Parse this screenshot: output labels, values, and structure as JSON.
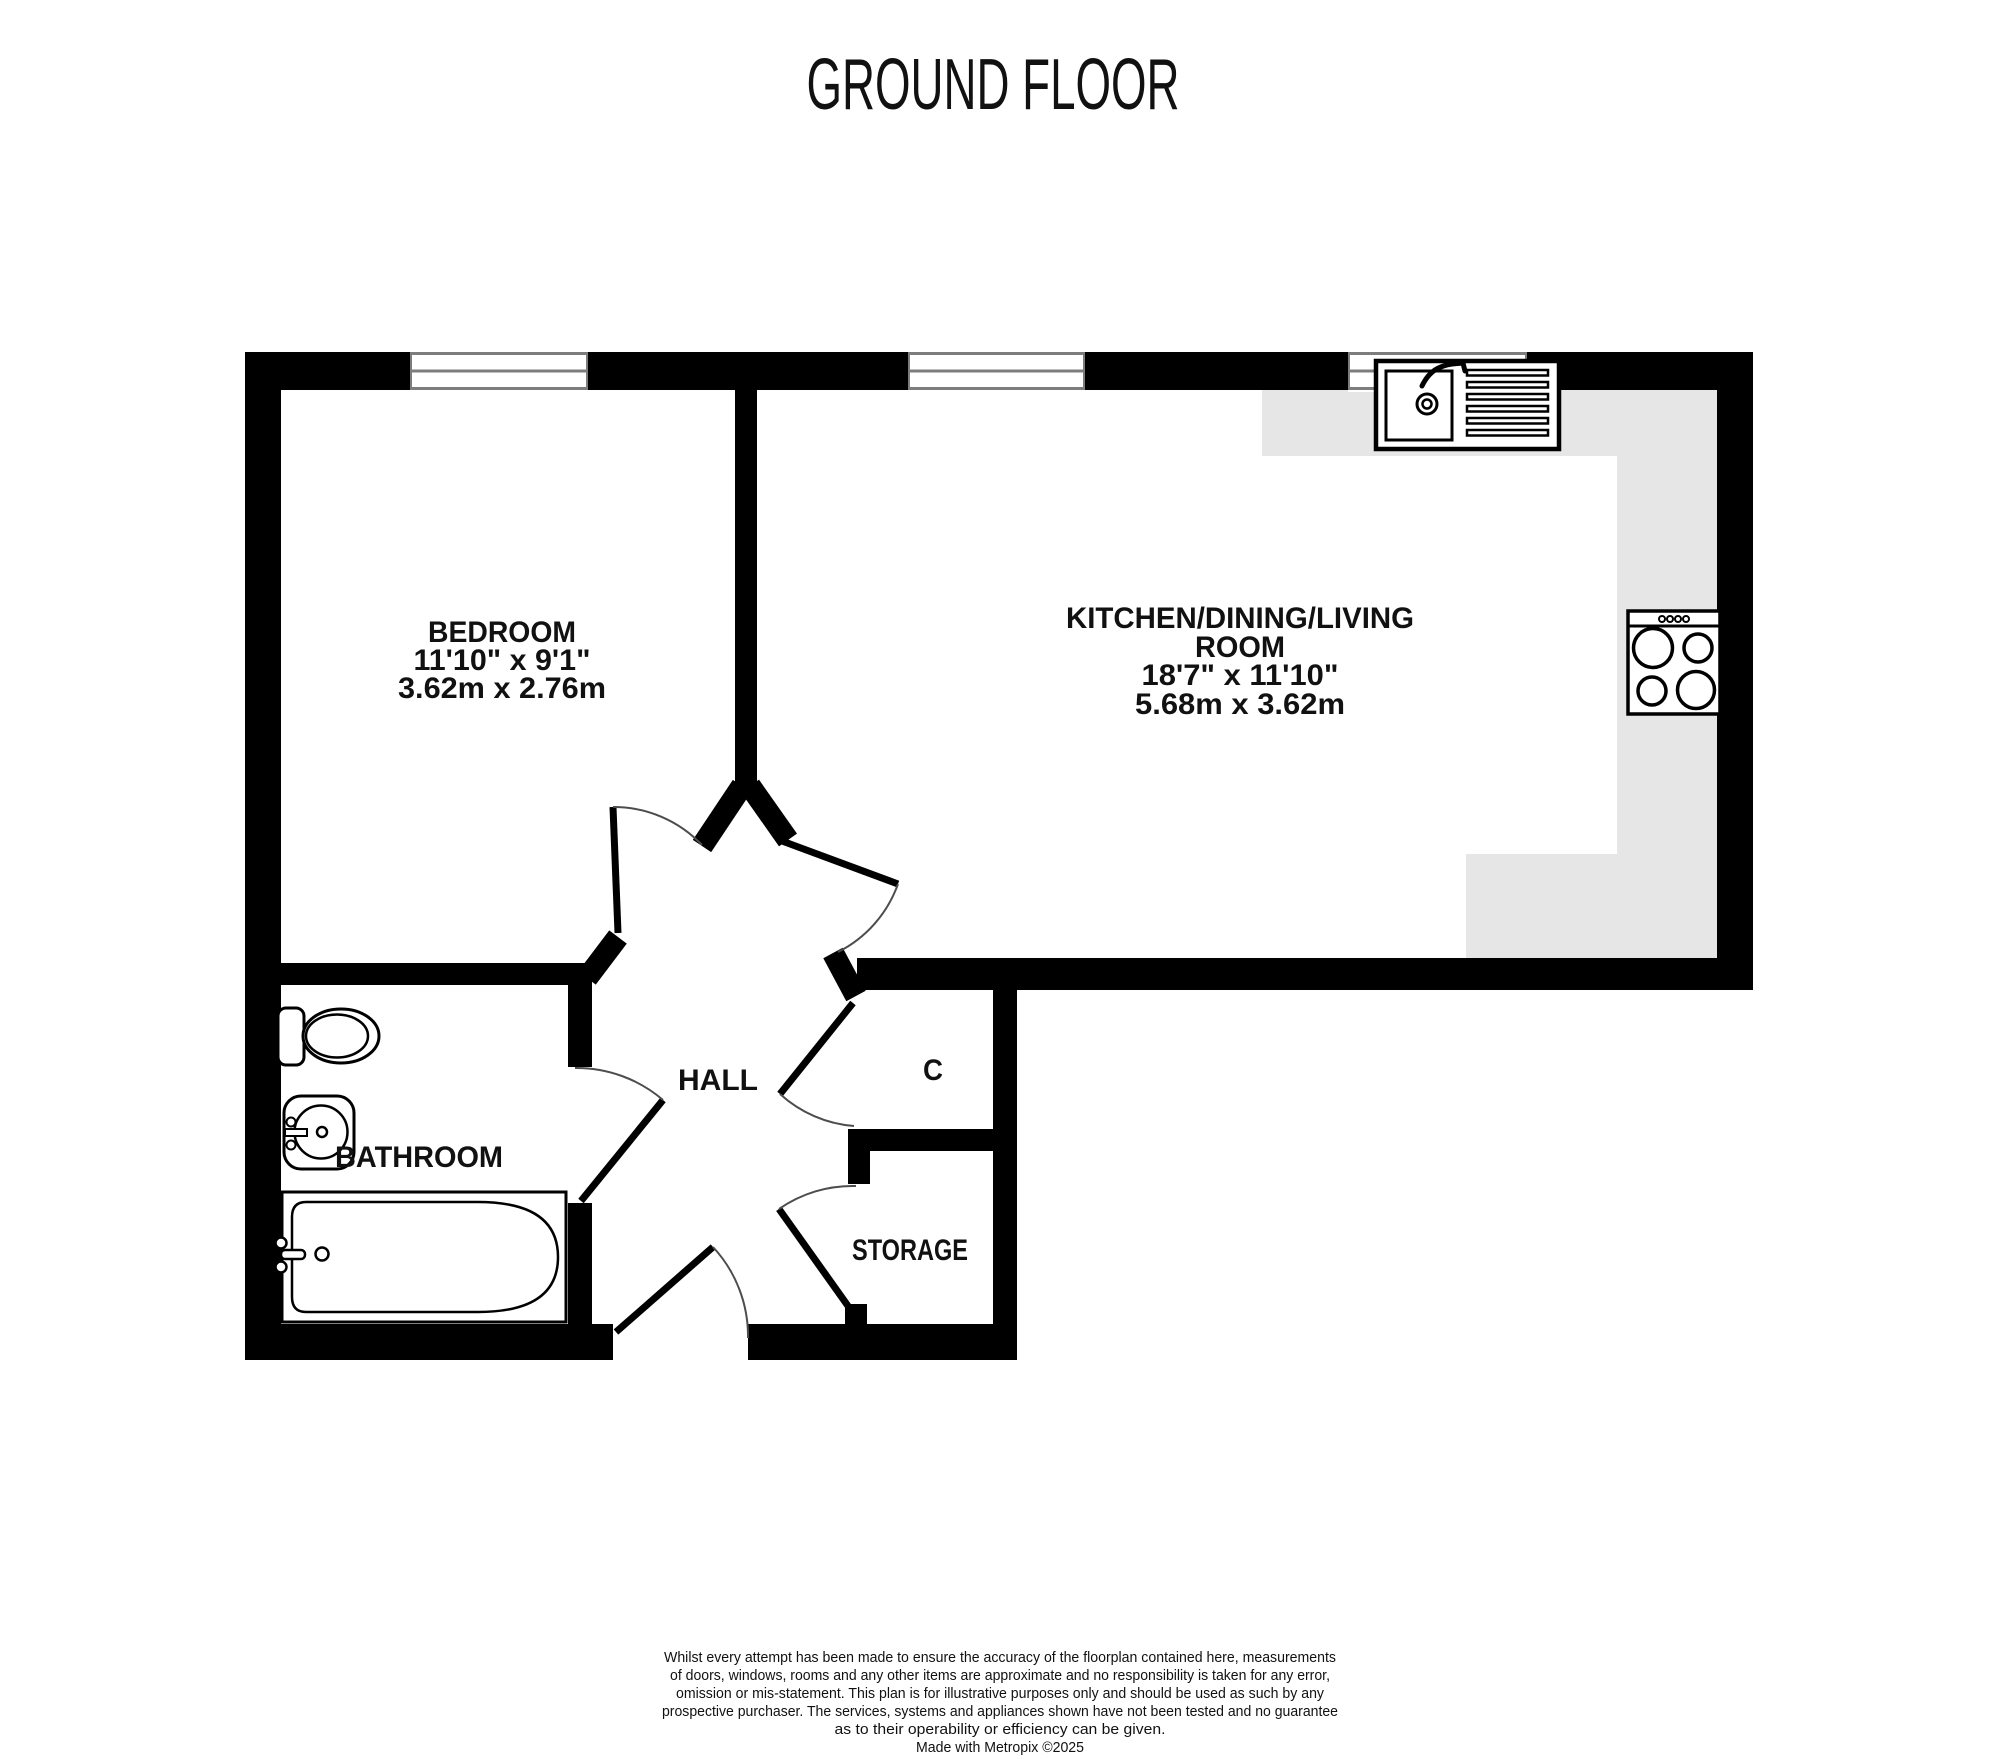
{
  "title": "GROUND FLOOR",
  "colors": {
    "wall": "#000000",
    "counter": "#e6e6e6",
    "window": "#7d7d7d",
    "arc": "#4d4d4d",
    "paper": "#ffffff",
    "text": "#111111"
  },
  "rooms": {
    "bedroom": {
      "name": "BEDROOM",
      "imperial": "11'10\"  x 9'1\"",
      "metric": "3.62m  x 2.76m"
    },
    "kitchen": {
      "name1": "KITCHEN/DINING/LIVING",
      "name2": "ROOM",
      "imperial": "18'7\"  x 11'10\"",
      "metric": "5.68m  x 3.62m"
    },
    "hall": {
      "name": "HALL"
    },
    "bathroom": {
      "name": "BATHROOM"
    },
    "cupboard": {
      "name": "C"
    },
    "storage": {
      "name": "STORAGE"
    }
  },
  "fixtures": {
    "sink": "kitchen-sink-with-drainer",
    "hob": "four-ring-hob",
    "toilet": "toilet",
    "basin": "wash-basin",
    "bath": "bathtub"
  },
  "disclaimer": {
    "lines": [
      "Whilst every attempt has been made to ensure the accuracy of the floorplan contained here, measurements",
      "of doors, windows, rooms and any other items are approximate and no responsibility is taken for any error,",
      "omission or mis-statement. This plan is for illustrative purposes only and should be used as such by any",
      "prospective purchaser. The services, systems and appliances shown have not been tested and no guarantee",
      "as to their operability or efficiency can be given."
    ],
    "credit": "Made with Metropix ©2025"
  }
}
